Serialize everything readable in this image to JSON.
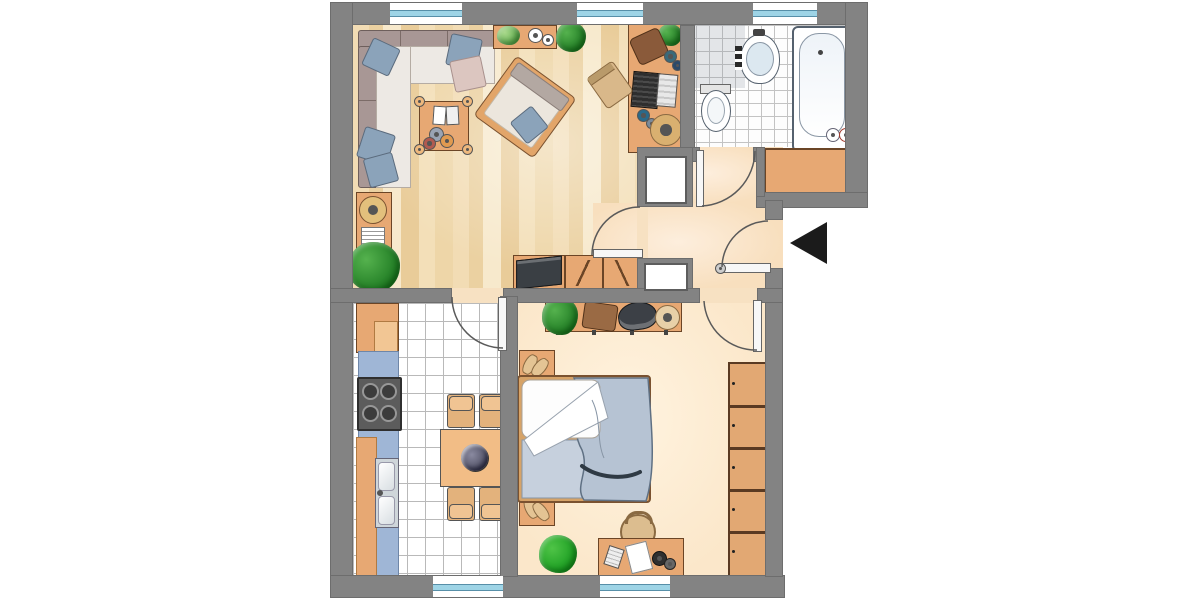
{
  "meta": {
    "type": "floor-plan",
    "description": "Top-down colored floor plan of a one-bedroom apartment with living room, bathroom, hall, kitchen and bedroom",
    "canvas": {
      "width": 1200,
      "height": 600
    }
  },
  "palette": {
    "wall_gray": "#838383",
    "exterior": "#ffffff",
    "parquet_wood": "#efd6a8",
    "hall_floor": "#f8dfbe",
    "bedroom_floor": "#fbe7ca",
    "tile_white": "#ffffff",
    "furniture_wood_orange": "#e7a873",
    "furniture_wood_light": "#f2bd86",
    "counter_blue": "#9fb6d6",
    "textile_blue": "#8ba3ba",
    "bedding_blue": "#b6c3d3",
    "plant_green": "#2f9e33",
    "window_glass_blue": "#9ed4e6",
    "entrance_marker_black": "#1b1b1b"
  },
  "labels": {
    "living_room": "Living room",
    "bathroom": "Bathroom",
    "hall": "Hall",
    "kitchen": "Kitchen",
    "bedroom": "Bedroom",
    "corner_sofa": "Corner sofa with cushions",
    "coffee_table": "Coffee table with books and cups",
    "armchair": "Armchair with cushion",
    "sideboard": "Sideboard with plant",
    "tv_lowboard": "TV lowboard",
    "living_desk": "Desk with laptop and office chair",
    "cabinet_lamp": "Cabinet with lamp and magazine rack",
    "bathtub": "Bathtub",
    "washbasin": "Washbasin",
    "toilet": "Toilet",
    "hall_cabinet": "Built-in cabinet",
    "niche": "Built-in niche",
    "kitchen_counter": "Kitchen counter",
    "stove": "Stove with four burners",
    "kitchen_sink": "Double kitchen sink",
    "dining_table": "Dining table with flower bouquet",
    "dining_chair": "Dining chair",
    "wall_shelf": "Wall shelf with plant, bag, hat and box",
    "double_bed": "Double bed with blue bedding",
    "nightstand": "Nightstand with slippers",
    "wardrobe": "Wardrobe with five sections",
    "bedroom_desk": "Desk with chair, paper, calculator and phone",
    "entrance_arrow": "Entrance arrow pointing left",
    "door": "Door with swing arc",
    "window": "Window"
  },
  "rooms": {
    "living_room": {
      "name": "Living room",
      "floor": "parquet",
      "windows": 2,
      "furniture": [
        "corner sofa",
        "5 cushions",
        "coffee table",
        "armchair",
        "sideboard",
        "2 plants",
        "TV lowboard",
        "desk with laptop",
        "office chair",
        "cabinet with lamp",
        "magazine rack",
        "floor plant"
      ]
    },
    "bathroom": {
      "name": "Bathroom",
      "floor": "tiles",
      "windows": 1,
      "fixtures": [
        "bathtub",
        "washbasin",
        "toilet",
        "built-in cabinet"
      ]
    },
    "hall": {
      "name": "Hall",
      "floor": "smooth",
      "windows": 0,
      "features": [
        "entrance door",
        "two built-in niches",
        "cabinet nook"
      ]
    },
    "kitchen": {
      "name": "Kitchen",
      "floor": "white tiles",
      "windows": 1,
      "furniture": [
        "counter",
        "stove",
        "double sink",
        "cabinets",
        "dining table",
        "4 chairs",
        "flower bouquet"
      ]
    },
    "bedroom": {
      "name": "Bedroom",
      "floor": "smooth",
      "windows": 1,
      "furniture": [
        "double bed",
        "2 nightstands",
        "slippers",
        "wall shelf",
        "wardrobe",
        "desk",
        "chair",
        "2 plants"
      ]
    }
  },
  "doors_count": 5,
  "windows_count": 5,
  "entrance": {
    "marker": "solid black triangle",
    "direction": "pointing left into entrance door",
    "side": "right"
  }
}
